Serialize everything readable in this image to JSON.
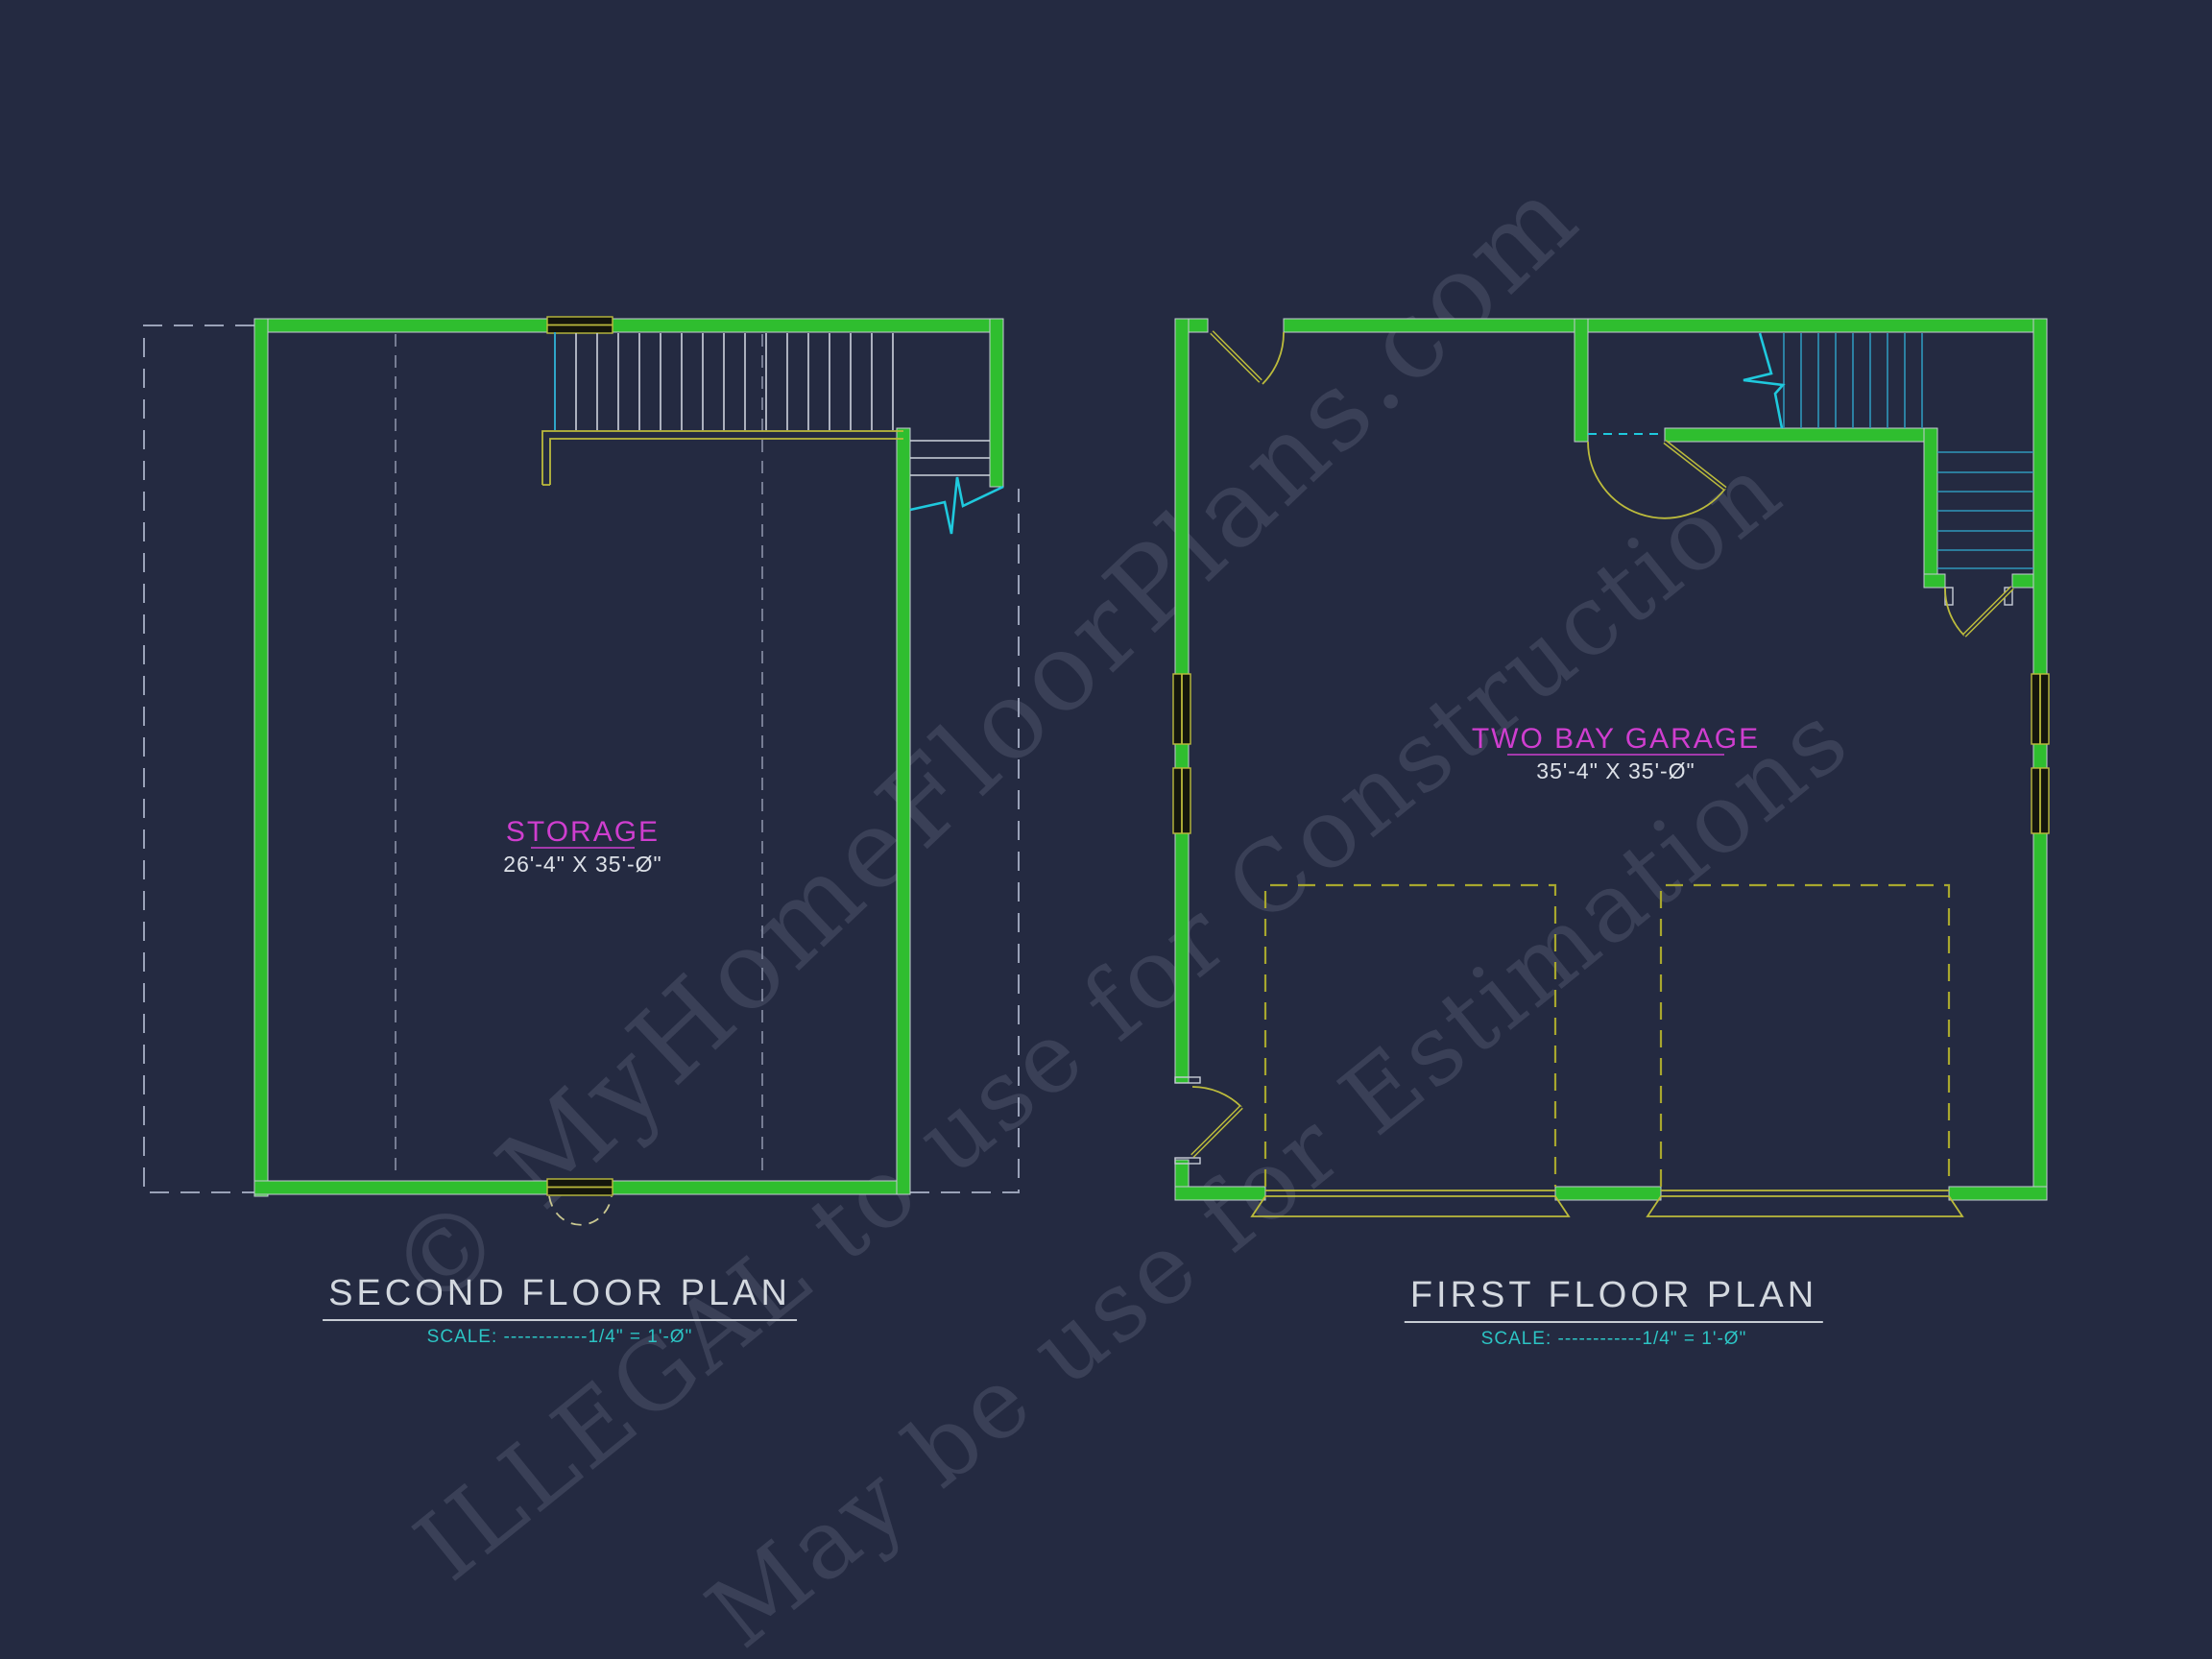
{
  "watermark": {
    "line1": "© MyHomeFloorPlans.com",
    "line2": "ILLEGAL to use for Construction",
    "line3": "May be use for Estimations"
  },
  "second_floor": {
    "room_label": "STORAGE",
    "room_dims": "26'-4\" X 35'-Ø\"",
    "title": "SECOND FLOOR PLAN",
    "scale": "SCALE: ------------1/4\" = 1'-Ø\""
  },
  "first_floor": {
    "room_label": "TWO BAY GARAGE",
    "room_dims": "35'-4\" X 35'-Ø\"",
    "title": "FIRST FLOOR PLAN",
    "scale": "SCALE: ------------1/4\" = 1'-Ø\""
  },
  "colors": {
    "background": "#242a41",
    "wall_green": "#2fbe2f",
    "door_yellow": "#bcbb3c",
    "stair_cyan": "#2e97ba",
    "break_cyan": "#1fc9dd",
    "label_magenta": "#cf3ecf",
    "dim_text": "#dde1e8",
    "title_text": "#d3d8df",
    "scale_cyan": "#2cc4c4",
    "watermark_gray": "#3d4156"
  }
}
